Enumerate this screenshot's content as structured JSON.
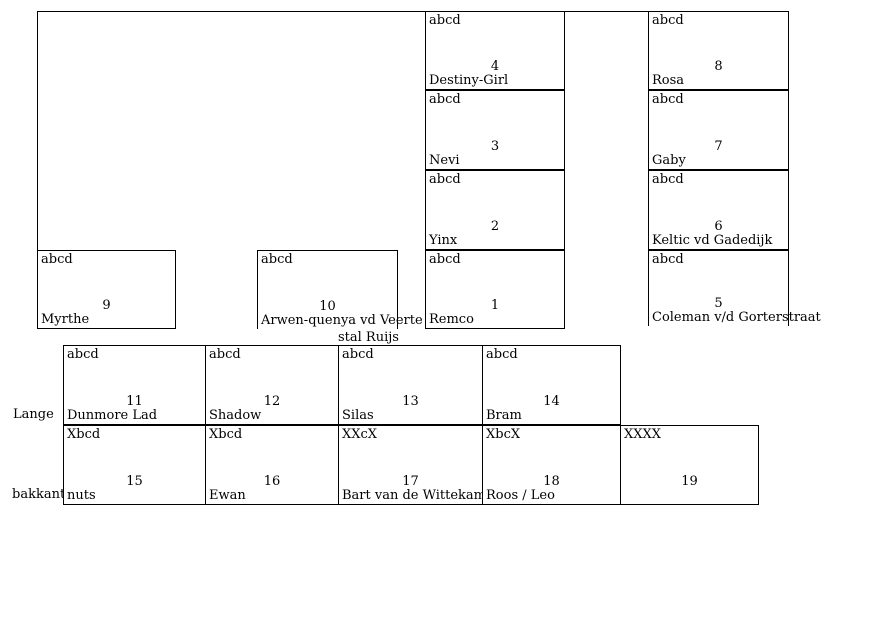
{
  "colors": {
    "line": "#000000",
    "text": "#000000",
    "background": "#ffffff"
  },
  "side_labels": {
    "lange": "Lange",
    "bakkant": "bakkant"
  },
  "stalls": {
    "s1": {
      "corner": "abcd",
      "number": "1",
      "name": "Remco"
    },
    "s2": {
      "corner": "abcd",
      "number": "2",
      "name": "Yinx"
    },
    "s3": {
      "corner": "abcd",
      "number": "3",
      "name": "Nevi"
    },
    "s4": {
      "corner": "abcd",
      "number": "4",
      "name": "Destiny-Girl"
    },
    "s5": {
      "corner": "abcd",
      "number": "5",
      "name": "Coleman v/d Gorterstraat"
    },
    "s6": {
      "corner": "abcd",
      "number": "6",
      "name": "Keltic vd Gadedijk"
    },
    "s7": {
      "corner": "abcd",
      "number": "7",
      "name": "Gaby"
    },
    "s8": {
      "corner": "abcd",
      "number": "8",
      "name": "Rosa"
    },
    "s9": {
      "corner": "abcd",
      "number": "9",
      "name": "Myrthe"
    },
    "s10": {
      "corner": "abcd",
      "number": "10",
      "name": "Arwen-quenya vd Veerte",
      "name_line2": "stal Ruijs"
    },
    "s11": {
      "corner": "abcd",
      "number": "11",
      "name": "Dunmore Lad"
    },
    "s12": {
      "corner": "abcd",
      "number": "12",
      "name": "Shadow"
    },
    "s13": {
      "corner": "abcd",
      "number": "13",
      "name": "Silas"
    },
    "s14": {
      "corner": "abcd",
      "number": "14",
      "name": "Bram"
    },
    "s15": {
      "corner": "Xbcd",
      "number": "15",
      "name": "nuts"
    },
    "s16": {
      "corner": "Xbcd",
      "number": "16",
      "name": "Ewan"
    },
    "s17": {
      "corner": "XXcX",
      "number": "17",
      "name": "Bart van de Wittekamp"
    },
    "s18": {
      "corner": "XbcX",
      "number": "18",
      "name": "Roos / Leo"
    },
    "s19": {
      "corner": "XXXX",
      "number": "19",
      "name": ""
    }
  }
}
